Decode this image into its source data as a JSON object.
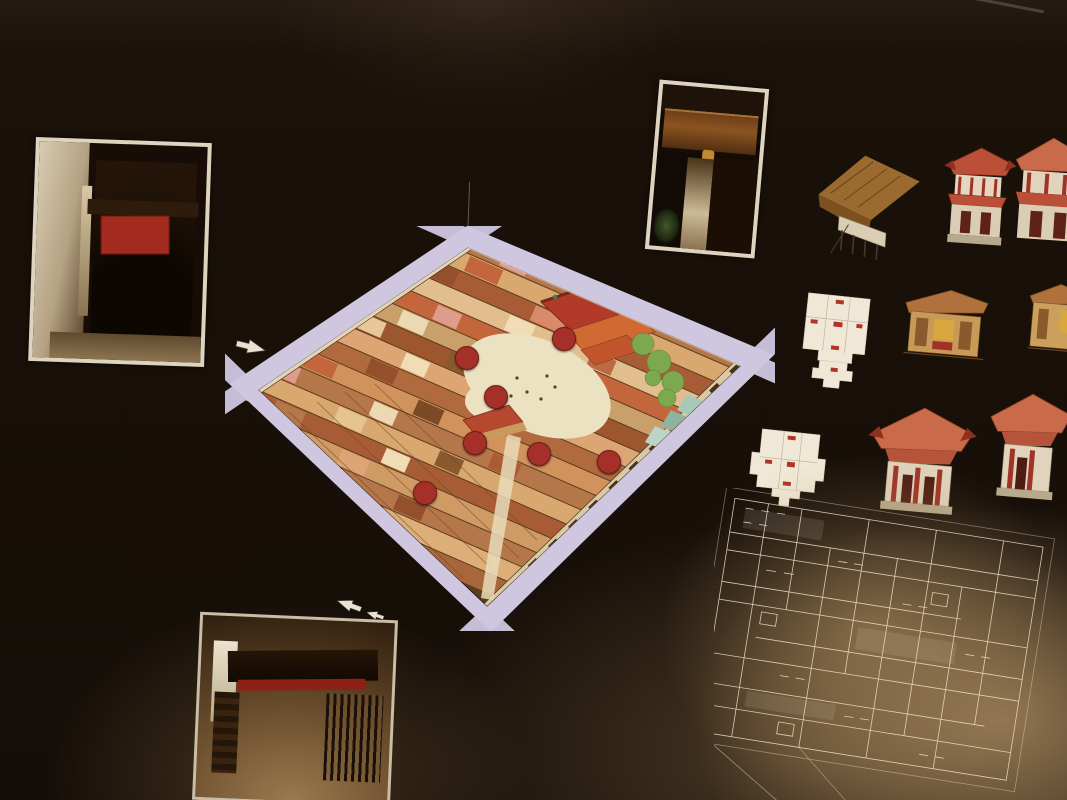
{
  "panel": {
    "intro_cn": {
      "line0": "在大铳巷，为主入口；",
      "lines": [
        "有屋精美门楼；另一为小巷侧门，可通本头公巷。紧密围",
        "筑群显示邱公司曾经是个向心力极强的宗族聚落，同时也反映出，",
        "世纪英殖民地正规社会保安不足的情况下，闽南人建立具有防御性",
        "空间以自卫。"
      ]
    },
    "intro_en": {
      "lines": [
        "The Leong San Tong Khoo Kongsi complex, which consists of the clanhouse Leong San Tong, an",
        "administration building with a meeting hall and offices, an opera stage, and 62 units of terrace houses",
        "and shophouses, is situated at the southwest of George Town. There are 3 entrances to the complex:",
        "the main entrance is at Cannon Street; the rear entrance, with a decorative archway, faces Beach",
        "Street; and the side entrance leads to Armenian Street. The closely-knit building complex is a",
        "reflection of the strong centripetalism and solidarity of the Khoos in the past. It also reflects the",
        "defensive instinct of the Hokkien community to safeguard against the inadequate public security",
        "during the British rule in the 19th century."
      ]
    },
    "dev_section": {
      "title_cn": "龍山堂建築的變遷",
      "title_en": "Architectural Development of Leong San Tong",
      "para1_lines": [
        "龙山堂位于广场中央，坐东朝偏南，向西北偏布，与新江大祖厝及公司毗邻交界 它",
        "总面宽七开间，平面呈亚字型，由三个不同高低部分组成，附以两廊居从单层的兴手",
        "层的主殿，以及走廊单层的遮陽棚 顏布这种楼及楼为其實是殖民地時代的一種混合",
        "体，它以闽南大厝带拜亭的布局，糅合各本土石脚洋楼所成"
      ],
      "para2_lines": [
        "初期洋楼被称为“印度马来亚加楼”，是马来西亚最早期殖民地时代发展出来的摸样",
        "1850年邱公司购下，隔年修葺成龙山堂宫殿的雄伟楼，使用途将十三年之久，直1894年来",
        "建时才设计殿以闽南建筑构造为主体的特色合并式，今天我们所看到的龙山堂，就是1906",
        "年二度重建后的模样。"
      ],
      "side_en_1": [
        "The clanhouse sits in the middle of the c",
        "programme Khoo Chan Eng's words w",
        "a prayer pavilion which is about half a s",
        "kitchen on the east wing to the left. The a",
        "Fujian with a prayer pavilion and that of a c"
      ],
      "side_en_2": [
        "Architecturally, the original bungalow in which",
        "developed based on the Malay stilt homes during",
        "in 1850s and converted it into a clanhouse in 185",
        "rebuilt based mainly on the southern Fujian archite",
        "which was completed in 1906."
      ]
    },
    "photos": {
      "armenian": {
        "sign": "新江",
        "caption_cn": "本头公巷 (侧巷入口)。",
        "caption_en": "Armenian Street (side entrance)"
      },
      "beach": {
        "caption_cn": "峨罗申街入口",
        "caption_en": "Beach Street entrance"
      },
      "gate": {
        "sign_cn": "司公邱堂山龍",
        "sign_en": "LEONG SAN TONG KHOO KONGSI",
        "caption_cn": "龙山堂邱公司正入口）"
      }
    },
    "legend": {
      "items": [
        {
          "num": "1.",
          "cn": "龙山堂",
          "en": "Clanhouse"
        },
        {
          "num": "2.",
          "cn": "戏台",
          "en": "Opera stage"
        },
        {
          "num": "3.",
          "cn": "会议厅",
          "en": "Office & Meeting hall"
        },
        {
          "num": "4.",
          "cn": "八间厝",
          "en": "8 houses"
        },
        {
          "num": "5.",
          "cn": "十六间厝",
          "en": "16 houses"
        },
        {
          "num": "6.",
          "cn": "打石街十六间厝",
          "en": "16 houses Acheen Street"
        },
        {
          "num": "7.",
          "cn": "炮台内",
          "en": "Cannon Square"
        }
      ]
    },
    "map": {
      "markers": [
        "1",
        "2",
        "3",
        "4",
        "5",
        "6",
        "7"
      ]
    },
    "gallery": [
      {
        "cn": "早期本土石脚洋楼",
        "en": "Early local bungalow with front porch"
      },
      {
        "cn": "闽南大厝带拜亭中庭",
        "en": "Southern Fujian temple with prayer pavilion"
      },
      {
        "cn": "龙山堂",
        "en": "Clanhouse"
      },
      {
        "cn": "龙山堂底层平面图",
        "en": "Floor plan of the clanhouse"
      },
      {
        "cn": "主殿拜亭剖立面图",
        "en": "Cross section illustration of the building proper"
      },
      {
        "cn": "龙山堂平面图",
        "en": "Floor plan of clanhouse"
      },
      {
        "cn": "龙山堂正立面图",
        "en": "Front elevation of clanhouse"
      }
    ],
    "survey_note": {
      "cn_lines": [
        "1891–1993年乔治市测绘图上的邱公司建筑群",
        "显然是个高度隐蔽却具防卫性的宗族聚落，没",
        "有明显的出入口。居然，当年的出入口竟是峨",
        "罗申街（图取自档案馆藏）"
      ],
      "en_lines": [
        "The 1891-1893 George Town Survey Plan shows that the complex",
        "was well protected amidst the shophouses clusters. The rear",
        "entrance was originally at Beach Street, but the whole frontage",
        "could hardly be noticed amidst the rows of shophouses."
      ]
    }
  }
}
